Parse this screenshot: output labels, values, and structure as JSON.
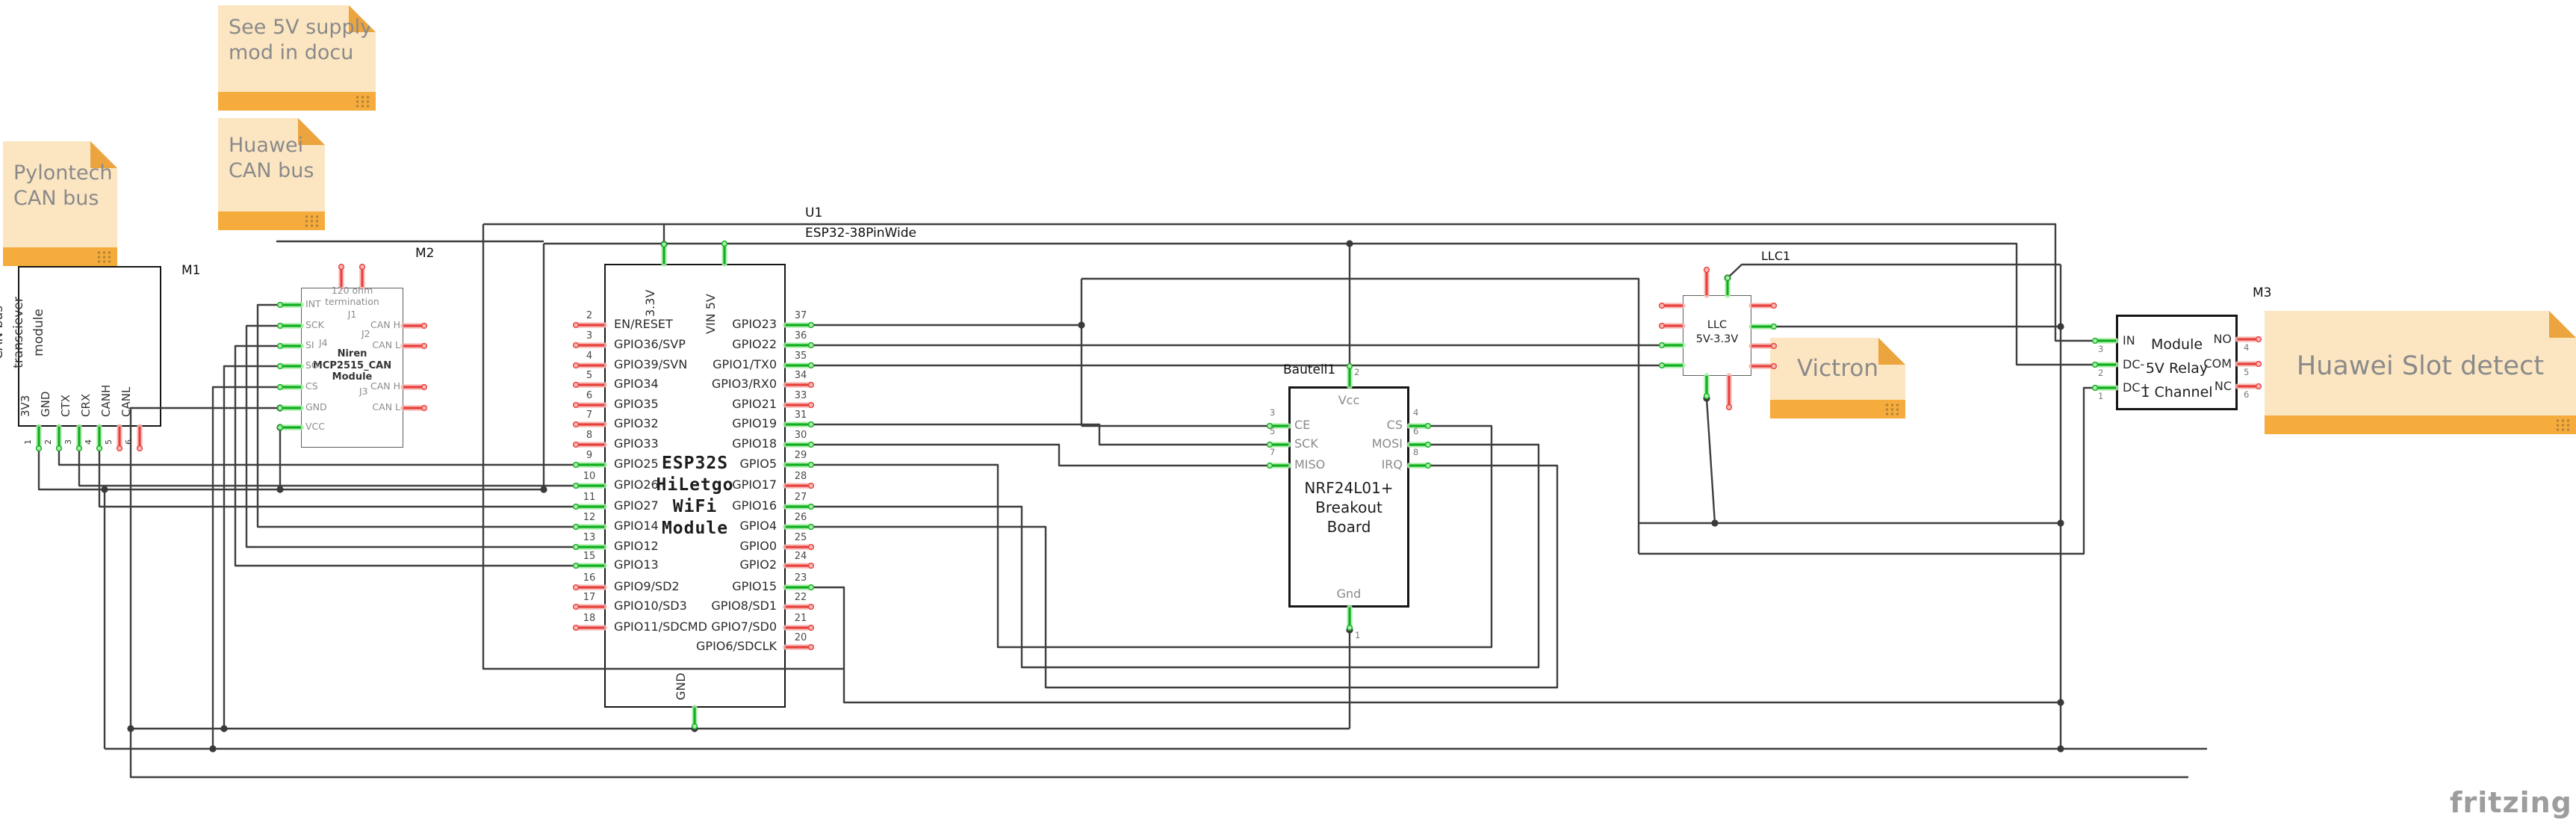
{
  "app": {
    "logo": "fritzing"
  },
  "colors": {
    "wire": "#3f3f3f",
    "pin_connected": "#0faf1e",
    "pin_connected_halo": "#a8eda8",
    "pin_free": "#e8413c",
    "pin_free_halo": "#f6b7b3",
    "note_bg": "#fce6c2",
    "note_strip": "#f5ac3c",
    "note_text": "#8a8a8a"
  },
  "notes": {
    "see_5v": {
      "text": "See 5V supply\nmod in docu"
    },
    "huawei_can": {
      "text": "Huawei\nCAN bus"
    },
    "pylontech": {
      "text": "Pylontech\nCAN bus"
    },
    "victron": {
      "text": "Victron"
    },
    "huawei_slot": {
      "text": "Huawei Slot detect"
    }
  },
  "modules": {
    "m1": {
      "ref": "M1",
      "title": "SN65HVD230\nCAN bus\ntransciever\nmodule",
      "pins": [
        {
          "num": "1",
          "label": "3V3",
          "connected": true
        },
        {
          "num": "2",
          "label": "GND",
          "connected": true
        },
        {
          "num": "3",
          "label": "CTX",
          "connected": true
        },
        {
          "num": "4",
          "label": "CRX",
          "connected": true
        },
        {
          "num": "5",
          "label": "CANH",
          "connected": false
        },
        {
          "num": "6",
          "label": "CANL",
          "connected": false
        }
      ]
    },
    "m2": {
      "ref": "M2",
      "termination_note": "120 ohm\ntermination",
      "jumpers": {
        "j1": "J1",
        "j2": "J2",
        "j3": "J3",
        "j4": "J4"
      },
      "brand": "Niren\nMCP2515_CAN\nModule",
      "left_pins": [
        {
          "label": "INT",
          "connected": true
        },
        {
          "label": "SCK",
          "connected": true
        },
        {
          "label": "SI",
          "connected": true
        },
        {
          "label": "SO",
          "connected": true
        },
        {
          "label": "CS",
          "connected": true
        },
        {
          "label": "GND",
          "connected": true
        },
        {
          "label": "VCC",
          "connected": true
        }
      ],
      "right_pins": [
        {
          "label": "CAN H",
          "connected": false
        },
        {
          "label": "CAN L",
          "connected": false
        },
        {
          "label": "CAN H",
          "connected": false
        },
        {
          "label": "CAN L",
          "connected": false
        }
      ],
      "top_pins": [
        {
          "label": "",
          "connected": false
        },
        {
          "label": "",
          "connected": false
        }
      ]
    },
    "esp32": {
      "ref": "U1",
      "part": "ESP32-38PinWide",
      "center": "ESP32S\nHiLetgo\nWiFi\nModule",
      "top_pins": [
        {
          "label": "3.3V"
        },
        {
          "label": "VIN 5V"
        }
      ],
      "bottom_pins": [
        {
          "label": "GND"
        }
      ],
      "left_pins": [
        {
          "num": "2",
          "label": "EN/RESET",
          "connected": false
        },
        {
          "num": "3",
          "label": "GPIO36/SVP",
          "connected": false
        },
        {
          "num": "4",
          "label": "GPIO39/SVN",
          "connected": false
        },
        {
          "num": "5",
          "label": "GPIO34",
          "connected": false
        },
        {
          "num": "6",
          "label": "GPIO35",
          "connected": false
        },
        {
          "num": "7",
          "label": "GPIO32",
          "connected": false
        },
        {
          "num": "8",
          "label": "GPIO33",
          "connected": false
        },
        {
          "num": "9",
          "label": "GPIO25",
          "connected": true
        },
        {
          "num": "10",
          "label": "GPIO26",
          "connected": true
        },
        {
          "num": "11",
          "label": "GPIO27",
          "connected": true
        },
        {
          "num": "12",
          "label": "GPIO14",
          "connected": true
        },
        {
          "num": "13",
          "label": "GPIO12",
          "connected": true
        },
        {
          "num": "15",
          "label": "GPIO13",
          "connected": true
        },
        {
          "num": "16",
          "label": "GPIO9/SD2",
          "connected": false
        },
        {
          "num": "17",
          "label": "GPIO10/SD3",
          "connected": false
        },
        {
          "num": "18",
          "label": "GPIO11/SDCMD",
          "connected": false
        }
      ],
      "right_pins": [
        {
          "num": "37",
          "label": "GPIO23",
          "connected": true
        },
        {
          "num": "36",
          "label": "GPIO22",
          "connected": true
        },
        {
          "num": "35",
          "label": "GPIO1/TX0",
          "connected": true
        },
        {
          "num": "34",
          "label": "GPIO3/RX0",
          "connected": false
        },
        {
          "num": "33",
          "label": "GPIO21",
          "connected": false
        },
        {
          "num": "31",
          "label": "GPIO19",
          "connected": true
        },
        {
          "num": "30",
          "label": "GPIO18",
          "connected": true
        },
        {
          "num": "29",
          "label": "GPIO5",
          "connected": true
        },
        {
          "num": "28",
          "label": "GPIO17",
          "connected": false
        },
        {
          "num": "27",
          "label": "GPIO16",
          "connected": true
        },
        {
          "num": "26",
          "label": "GPIO4",
          "connected": true
        },
        {
          "num": "25",
          "label": "GPIO0",
          "connected": false
        },
        {
          "num": "24",
          "label": "GPIO2",
          "connected": false
        },
        {
          "num": "23",
          "label": "GPIO15",
          "connected": true
        },
        {
          "num": "22",
          "label": "GPIO8/SD1",
          "connected": false
        },
        {
          "num": "21",
          "label": "GPIO7/SD0",
          "connected": false
        },
        {
          "num": "20",
          "label": "GPIO6/SDCLK",
          "connected": false
        }
      ]
    },
    "nrf": {
      "ref": "Bauteil1",
      "center": "NRF24L01+\nBreakout\nBoard",
      "top_pin": {
        "num": "2",
        "label": "Vcc"
      },
      "bottom_pin": {
        "num": "1",
        "label": "Gnd"
      },
      "left_pins": [
        {
          "num": "3",
          "label": "CE"
        },
        {
          "num": "5",
          "label": "SCK"
        },
        {
          "num": "7",
          "label": "MISO"
        }
      ],
      "right_pins": [
        {
          "num": "4",
          "label": "CS"
        },
        {
          "num": "6",
          "label": "MOSI"
        },
        {
          "num": "8",
          "label": "IRQ"
        }
      ]
    },
    "llc": {
      "ref": "LLC1",
      "label": "LLC\n5V-3.3V"
    },
    "relay": {
      "ref": "M3",
      "center": "Module\n5V Relay\n1 Channel",
      "left_pins": [
        {
          "num": "3",
          "label": "IN"
        },
        {
          "num": "2",
          "label": "DC-"
        },
        {
          "num": "1",
          "label": "DC+"
        }
      ],
      "right_pins": [
        {
          "num": "4",
          "label": "NO"
        },
        {
          "num": "5",
          "label": "COM"
        },
        {
          "num": "6",
          "label": "NC"
        }
      ]
    }
  }
}
